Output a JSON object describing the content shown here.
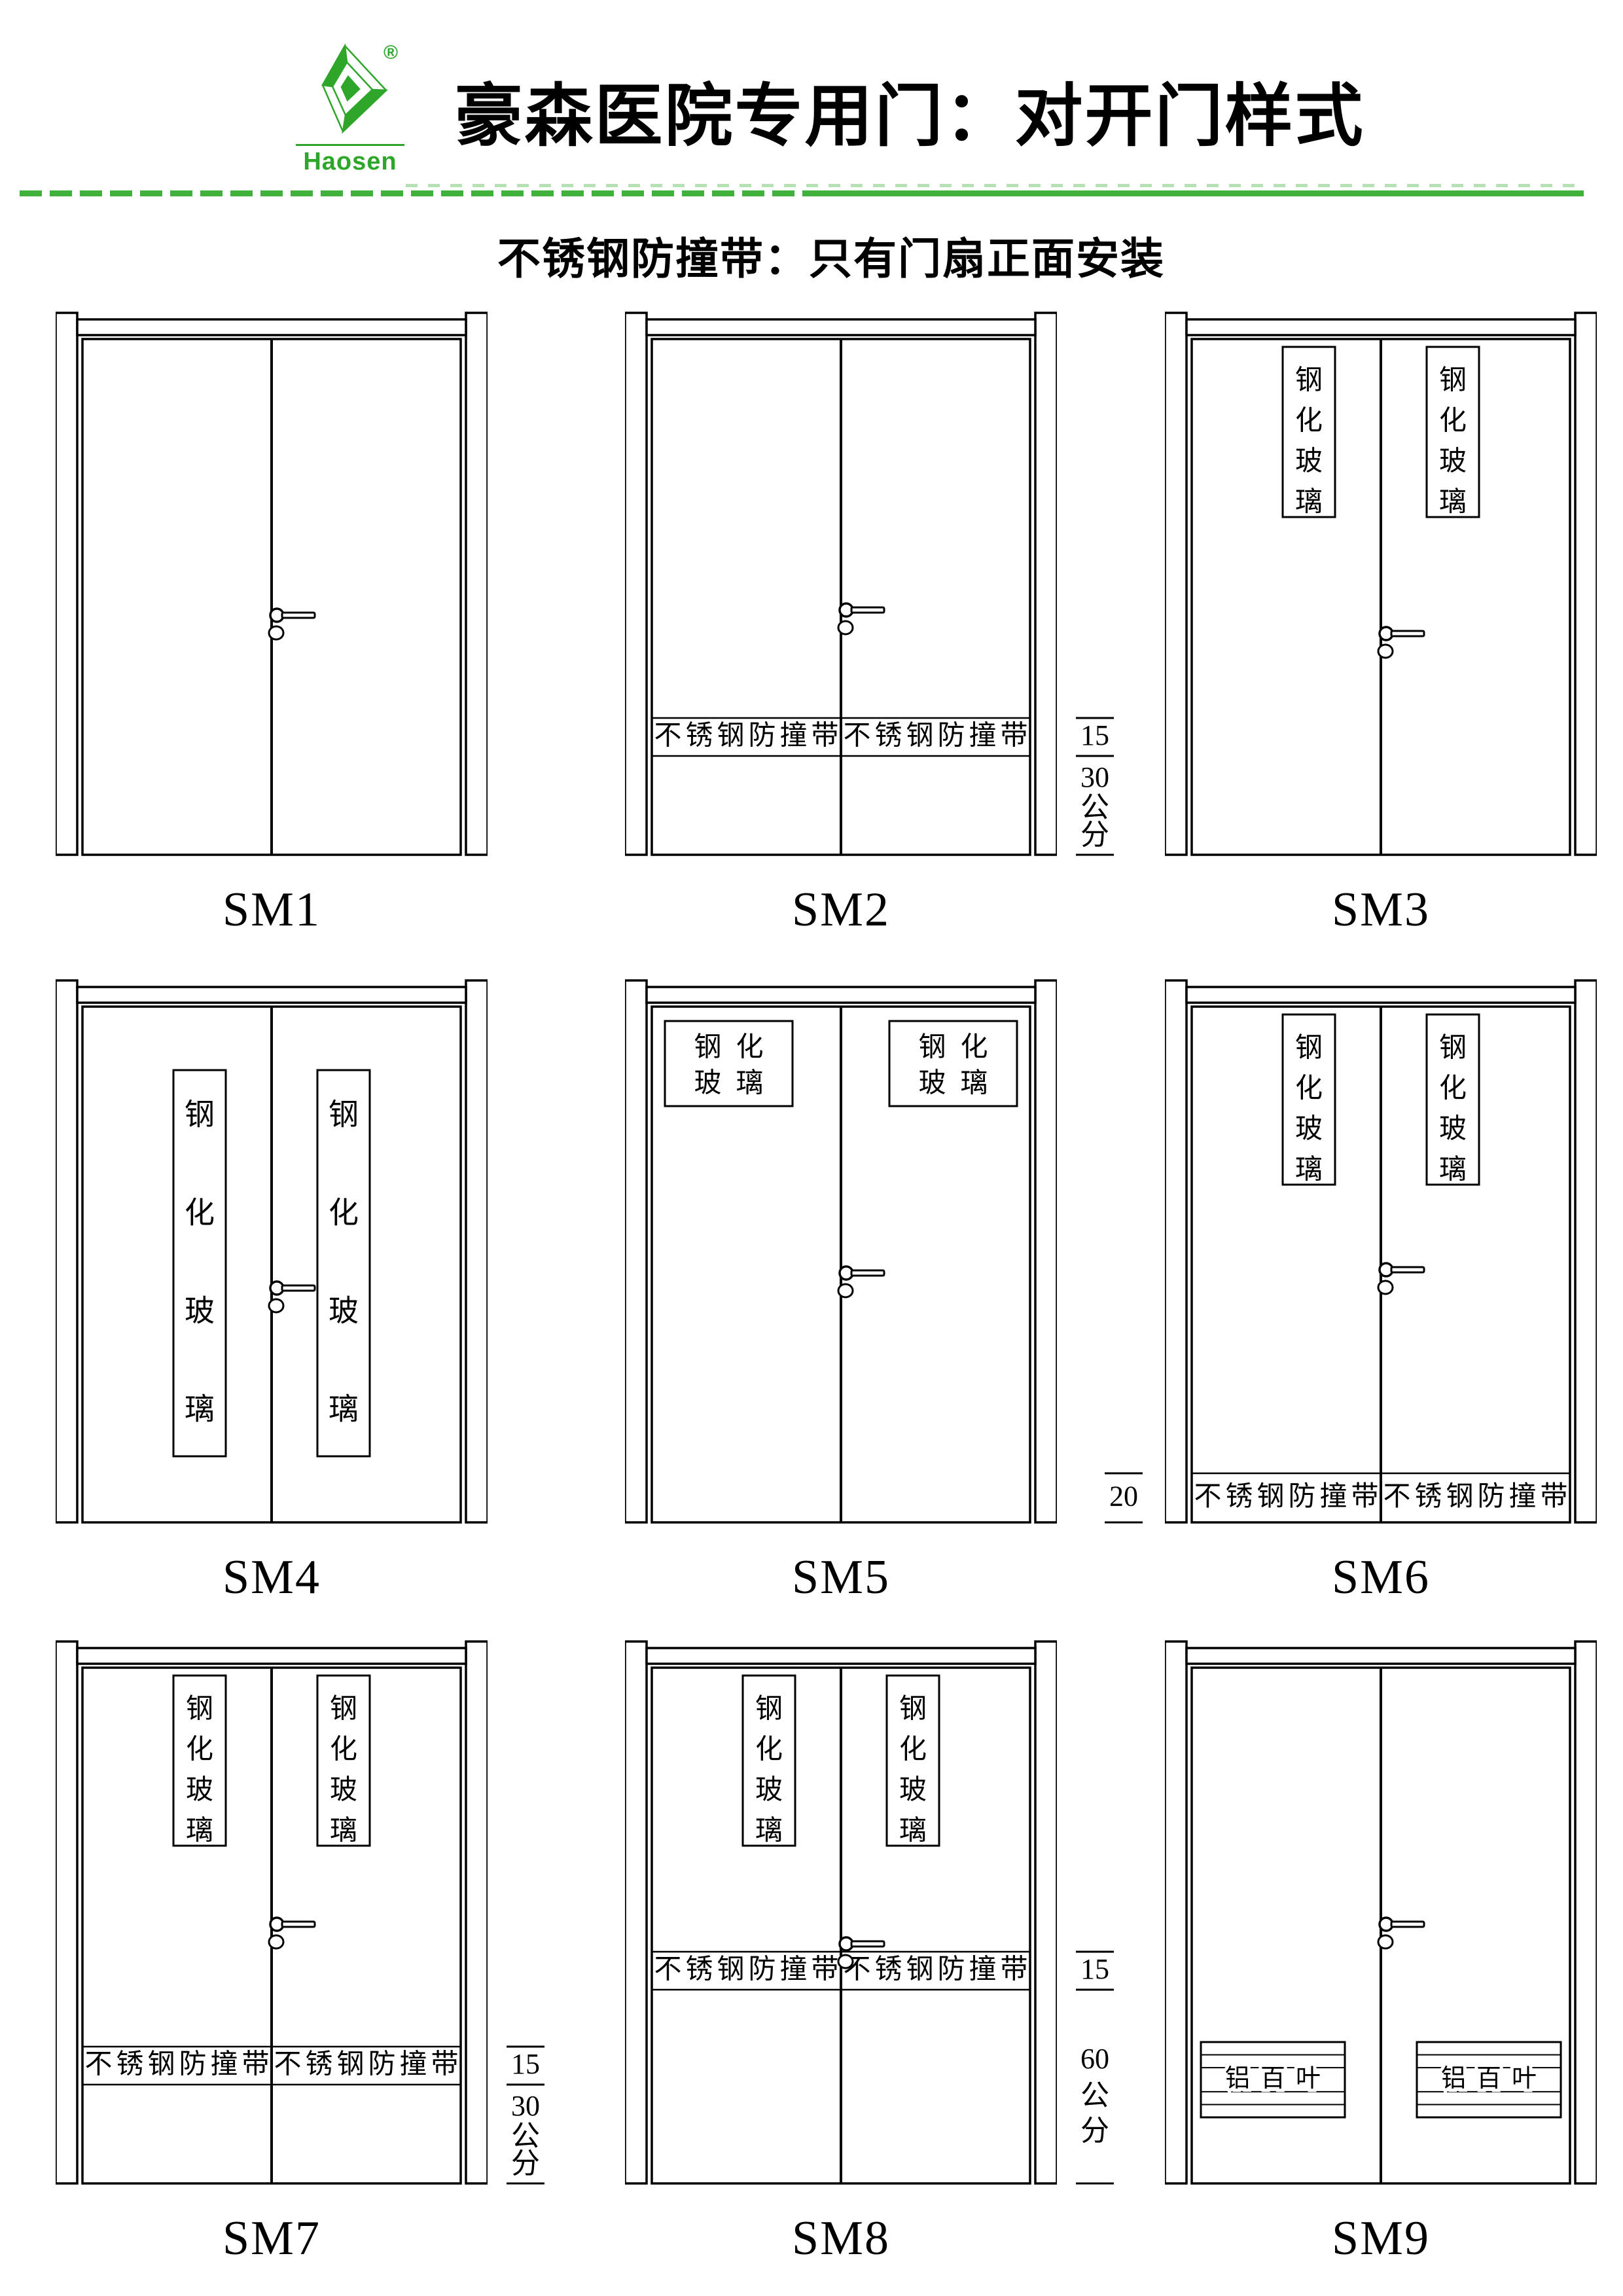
{
  "page": {
    "background": "#ffffff",
    "accent_green": "#2EA62A",
    "divider_green": "#3FB13C",
    "faint_green": "#A9DCA6",
    "ink": "#000000"
  },
  "header": {
    "logo": {
      "brand": "Haosen",
      "registered_mark": "®"
    },
    "title": "豪森医院专用门：对开门样式",
    "subtitle": "不锈钢防撞带：只有门扇正面安装"
  },
  "labels": {
    "tempered_glass_chars": [
      "钢",
      "化",
      "玻",
      "璃"
    ],
    "tempered_glass_rows": [
      "钢化",
      "玻璃"
    ],
    "bump_strip": "不锈钢防撞带",
    "louver": "铝百叶"
  },
  "dim_labels": {
    "right-15-30": {
      "upper": "15",
      "lower": [
        "30",
        "公",
        "分"
      ]
    },
    "right-15-60": {
      "upper": "15",
      "lower": [
        "60",
        "公",
        "分"
      ]
    },
    "left-20": {
      "value": "20"
    }
  },
  "doors": [
    {
      "label": "SM1",
      "glass": "none",
      "band": "none",
      "louver": false,
      "dim": "none"
    },
    {
      "label": "SM2",
      "glass": "none",
      "band": "low",
      "louver": false,
      "dim": "right-15-30"
    },
    {
      "label": "SM3",
      "glass": "narrow",
      "band": "none",
      "louver": false,
      "dim": "none"
    },
    {
      "label": "SM4",
      "glass": "long",
      "band": "none",
      "louver": false,
      "dim": "none"
    },
    {
      "label": "SM5",
      "glass": "wide",
      "band": "none",
      "louver": false,
      "dim": "none"
    },
    {
      "label": "SM6",
      "glass": "narrow",
      "band": "floor",
      "louver": false,
      "dim": "left-20"
    },
    {
      "label": "SM7",
      "glass": "narrow",
      "band": "low",
      "louver": false,
      "dim": "right-15-30"
    },
    {
      "label": "SM8",
      "glass": "narrow",
      "band": "mid",
      "louver": false,
      "dim": "right-15-60"
    },
    {
      "label": "SM9",
      "glass": "none",
      "band": "none",
      "louver": true,
      "dim": "none"
    }
  ]
}
